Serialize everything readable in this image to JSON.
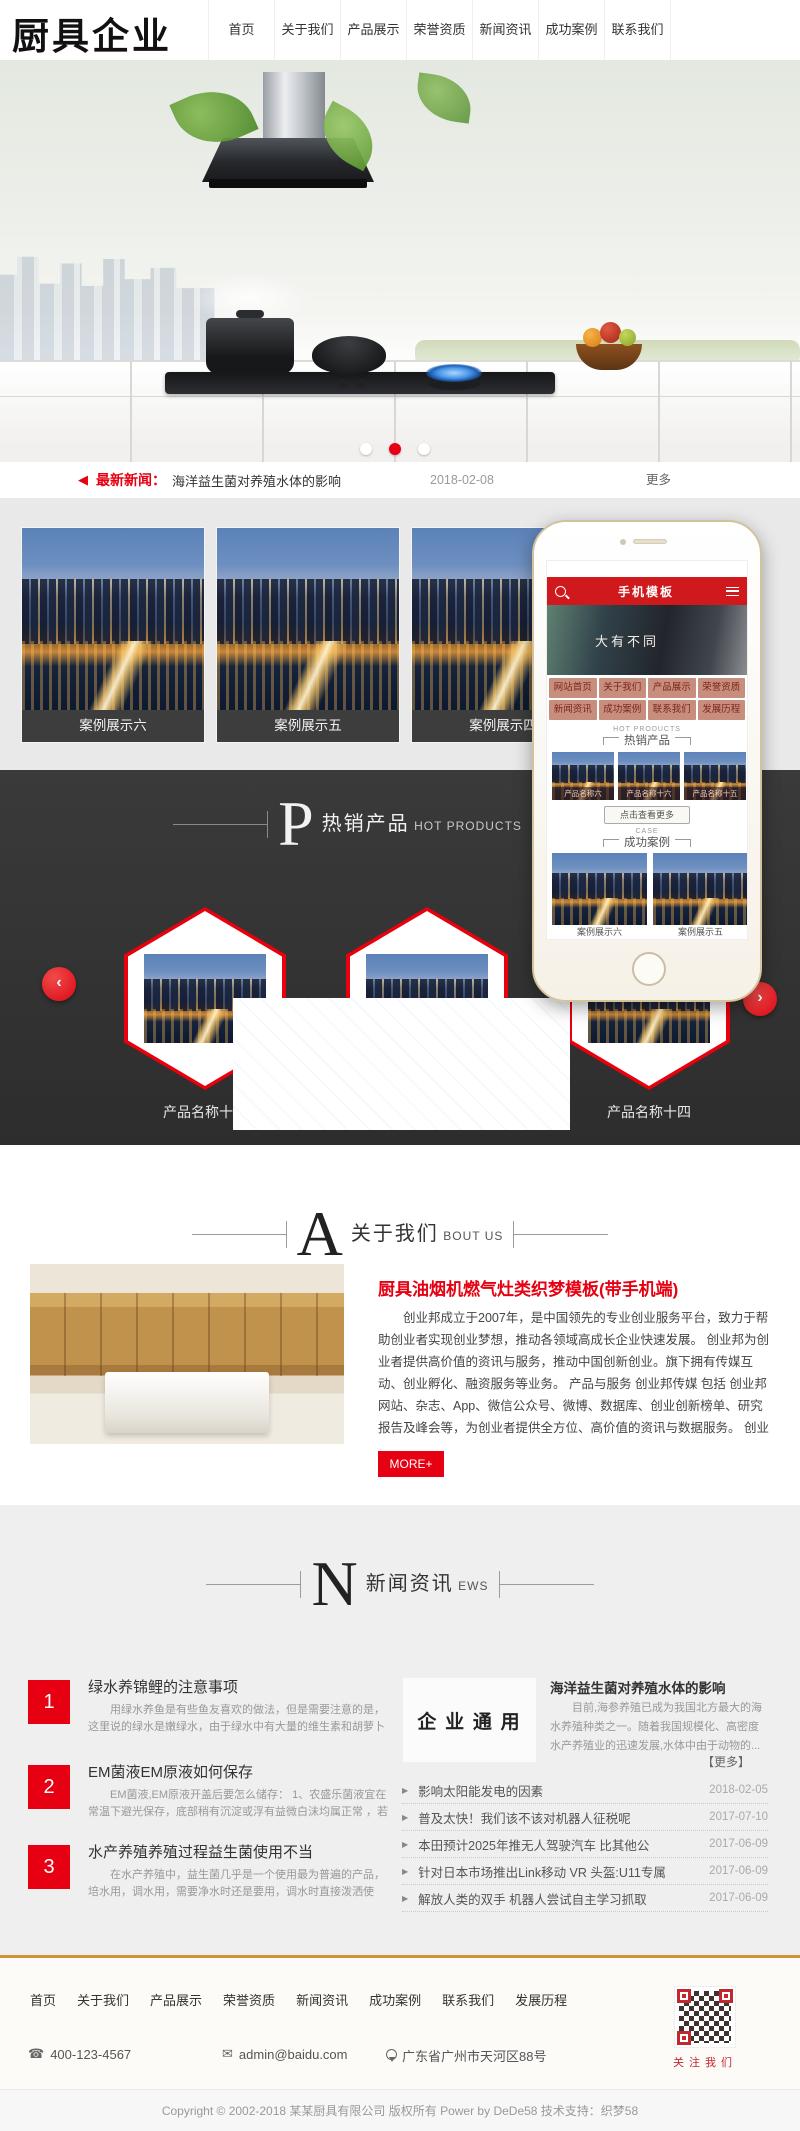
{
  "colors": {
    "accent": "#e60012",
    "red_dark": "#c1272d",
    "dark_section_bg": "#333333",
    "footer_top_line": "#cf9236",
    "phone_header_red": "#d0191c"
  },
  "header": {
    "logo": "厨具企业",
    "nav": [
      "首页",
      "关于我们",
      "产品展示",
      "荣誉资质",
      "新闻资讯",
      "成功案例",
      "联系我们"
    ]
  },
  "ticker": {
    "label": "最新新闻：",
    "title": "海洋益生菌对养殖水体的影响",
    "date": "2018-02-08",
    "more": "更多"
  },
  "cases": {
    "items": [
      "案例展示六",
      "案例展示五",
      "案例展示四"
    ]
  },
  "phone": {
    "title": "手机模板",
    "banner": "大有不同",
    "nav": [
      "网站首页",
      "关于我们",
      "产品展示",
      "荣誉资质",
      "新闻资讯",
      "成功案例",
      "联系我们",
      "发展历程"
    ],
    "hot_en": "HOT PRODUCTS",
    "hot_cn": "热销产品",
    "products": [
      "产品名称六",
      "产品名称十六",
      "产品名称十五"
    ],
    "more": "点击查看更多",
    "case_en": "CASE",
    "case_cn": "成功案例",
    "cases": [
      "案例展示六",
      "案例展示五"
    ]
  },
  "hot": {
    "initial": "P",
    "cn": "热销产品",
    "en": "HOT PRODUCTS",
    "items": [
      "产品名称十六",
      "产品名称十五",
      "产品名称十四"
    ]
  },
  "about": {
    "initial": "A",
    "cn": "关于我们",
    "en": "BOUT US",
    "title": "厨具油烟机燃气灶类织梦模板(带手机端)",
    "body": "创业邦成立于2007年，是中国领先的专业创业服务平台，致力于帮助创业者实现创业梦想，推动各领域高成长企业快速发展。 创业邦为创业者提供高价值的资讯与服务，推动中国创新创业。旗下拥有传媒互动、创业孵化、融资服务等业务。 产品与服务 创业邦传媒 包括 创业邦网站、杂志、App、微信公众号、微博、数据库、创业创新榜单、研究报告及峰会等，为创业者提供全方位、高价值的资讯与数据服务。 创业邦100未来领袖峰会每年一届，发布 创业邦...",
    "more": "MORE+"
  },
  "news": {
    "initial": "N",
    "cn": "新闻资讯",
    "en": "EWS",
    "items": [
      {
        "num": "1",
        "title": "绿水养锦鲤的注意事项",
        "excerpt": "用绿水养鱼是有些鱼友喜欢的做法，但是需要注意的是，这里说的绿水是嫩绿水，由于绿水中有大量的维生素和胡萝卜素，藻..."
      },
      {
        "num": "2",
        "title": "EM菌液EM原液如何保存",
        "excerpt": "EM菌液,EM原液开盖后要怎么储存： 1、农盛乐菌液宜在常温下避光保存，底部稍有沉淀或浮有益微白沫均属正常 ，若气味不..."
      },
      {
        "num": "3",
        "title": "水产养殖养殖过程益生菌使用不当",
        "excerpt": "在水产养殖中，益生菌几乎是一个使用最为普遍的产品，培水用，调水用，需要净水时还是要用，调水时直接泼洒使用，改底..."
      }
    ],
    "featured": {
      "logo": "企 业 通 用",
      "title": "海洋益生菌对养殖水体的影响",
      "excerpt": "目前,海参养殖已成为我国北方最大的海水养殖种类之一。随着我国规模化、高密度水产养殖业的迅速发展,水体中由于动物的...",
      "more": "【更多】"
    },
    "list": [
      {
        "title": "影响太阳能发电的因素",
        "date": "2018-02-05"
      },
      {
        "title": "普及太快！我们该不该对机器人征税呢",
        "date": "2017-07-10"
      },
      {
        "title": "本田预计2025年推无人驾驶汽车 比其他公",
        "date": "2017-06-09"
      },
      {
        "title": "针对日本市场推出Link移动 VR 头盔:U11专属",
        "date": "2017-06-09"
      },
      {
        "title": "解放人类的双手 机器人尝试自主学习抓取",
        "date": "2017-06-09"
      }
    ]
  },
  "footer": {
    "links": [
      "首页",
      "关于我们",
      "产品展示",
      "荣誉资质",
      "新闻资讯",
      "成功案例",
      "联系我们",
      "发展历程"
    ],
    "phone": "400-123-4567",
    "email": "admin@baidu.com",
    "address": "广东省广州市天河区88号",
    "follow": "关注我们",
    "copyright": "Copyright © 2002-2018 某某厨具有限公司 版权所有 Power by DeDe58 技术支持：织梦58"
  }
}
